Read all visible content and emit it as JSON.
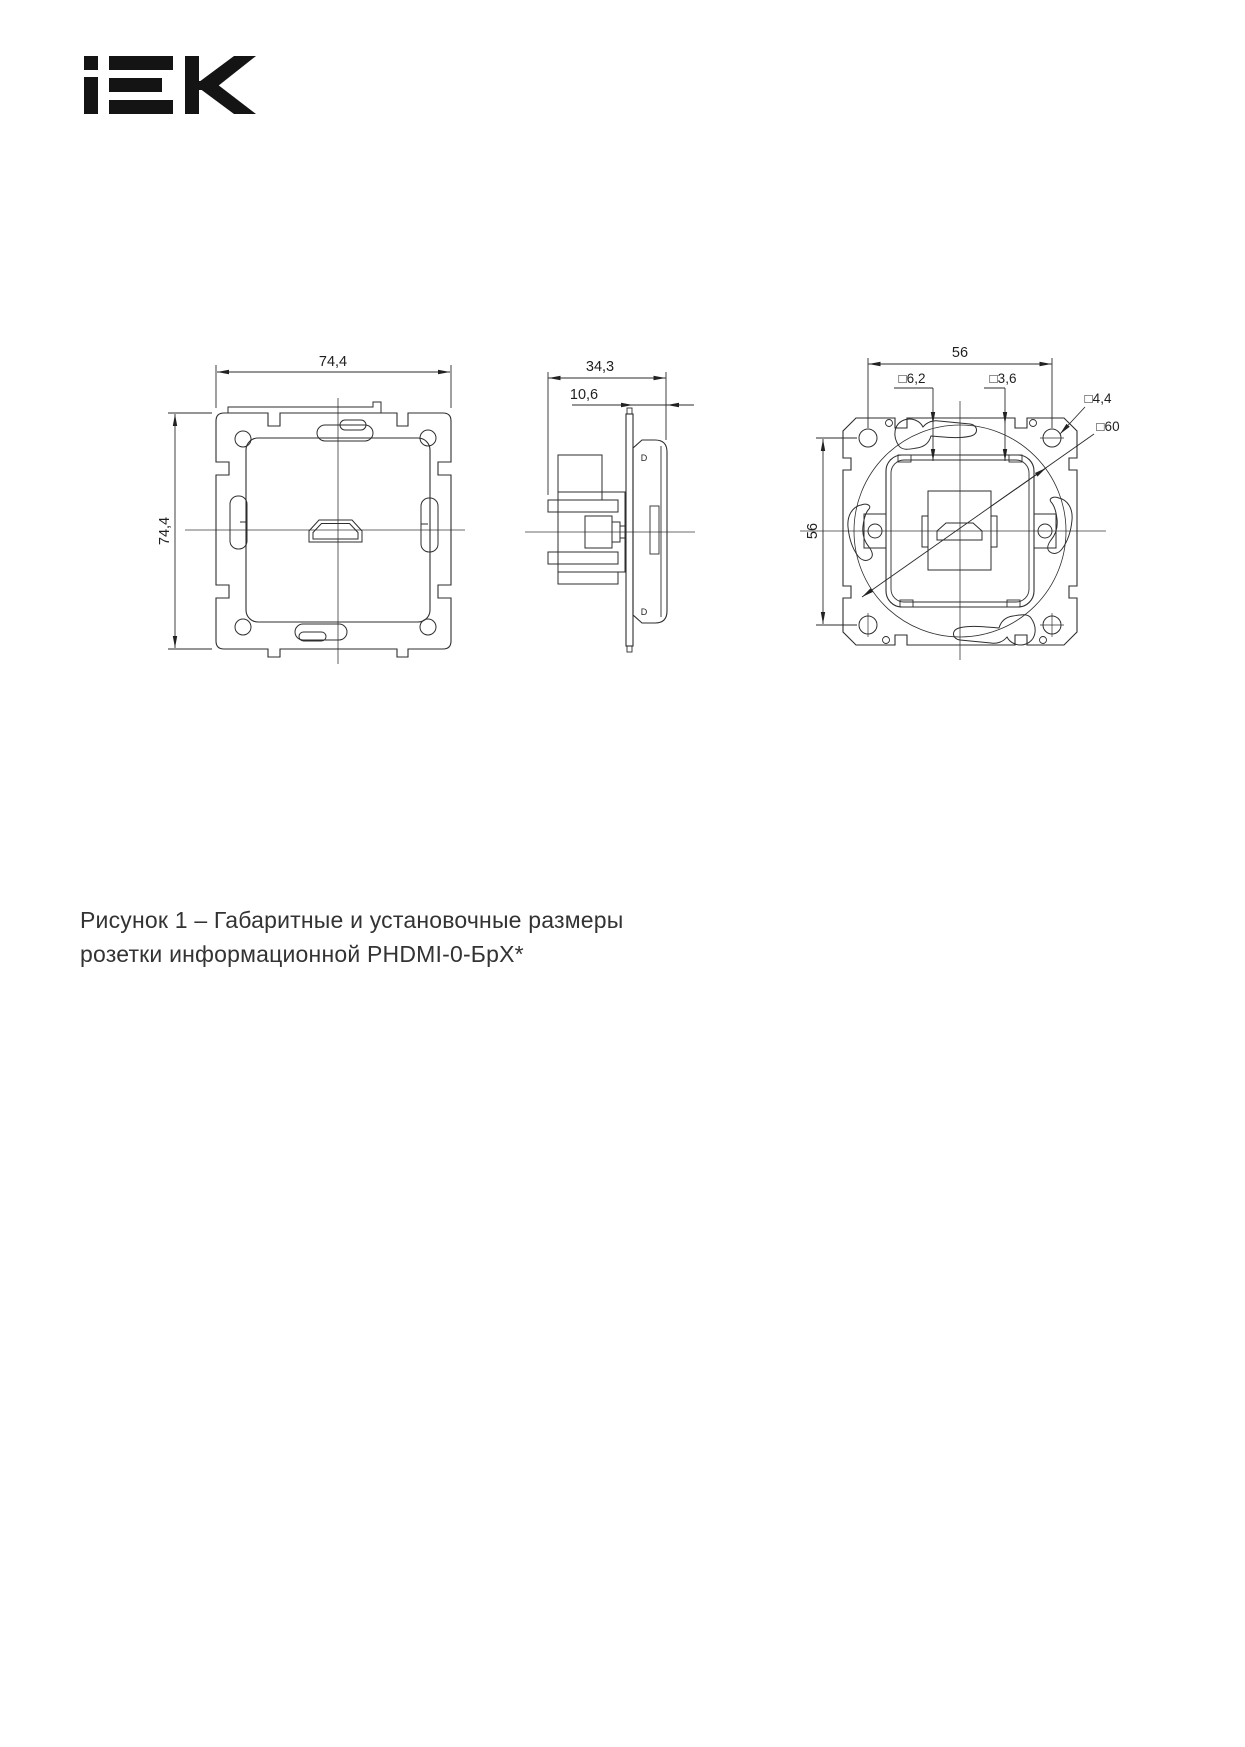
{
  "logo": {
    "brand": "IEK"
  },
  "drawings": {
    "front_view": {
      "width": "74,4",
      "height": "74,4"
    },
    "side_view": {
      "depth": "34,3",
      "front_depth": "10,6",
      "detail_top": "D",
      "detail_bottom": "D"
    },
    "rear_view": {
      "width": "56",
      "height": "56",
      "claw_slot": "□6,2",
      "clip_slot": "□3,6",
      "hole": "□4,4",
      "box_square": "□60"
    }
  },
  "caption": {
    "line1": "Рисунок 1 – Габаритные и установочные размеры",
    "line2": "розетки информационной PHDMI-0-БрХ*"
  }
}
